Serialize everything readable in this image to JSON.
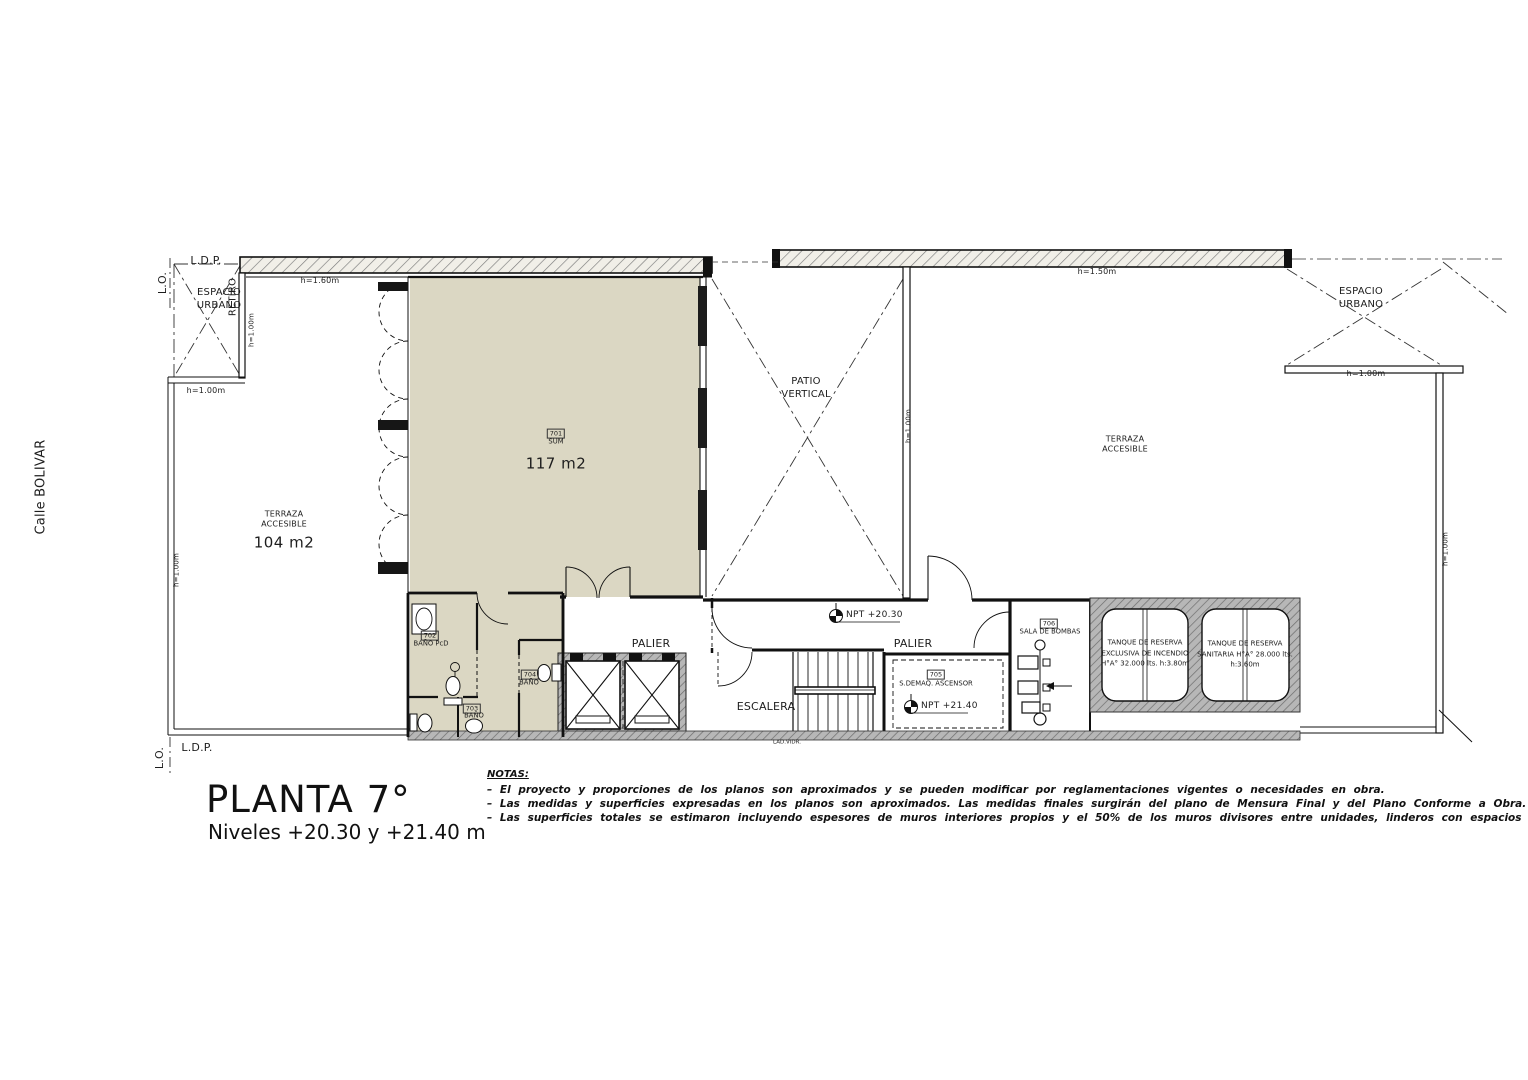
{
  "title_block": {
    "title": "PLANTA 7°",
    "subtitle": "Niveles +20.30 y +21.40 m"
  },
  "notes": {
    "heading": "NOTAS:",
    "items": [
      "– El proyecto y proporciones de los planos son aproximados y se pueden modificar por reglamentaciones vigentes o necesidades en obra.",
      "– Las medidas y superficies expresadas en los planos son aproximados. Las medidas finales surgirán del plano de Mensura Final y del Plano Conforme a Obra.",
      "– Las superficies totales se estimaron incluyendo espesores de muros interiores propios y el 50% de los muros divisores entre unidades, linderos con espacios comunes y medianeros."
    ]
  },
  "street": {
    "label": "Calle BOLIVAR"
  },
  "boundary": {
    "lo_top": "L.O.",
    "ldp_top": "L.D.P.",
    "lo_bottom": "L.O.",
    "ldp_bottom": "L.D.P."
  },
  "zones": {
    "espacio_urbano_left": "ESPACIO\nURBANO",
    "retiro": "RETIRO",
    "patio_vertical": "PATIO\nVERTICAL",
    "espacio_urbano_right": "ESPACIO\nURBANO",
    "terraza_left_name": "TERRAZA\nACCESIBLE",
    "terraza_left_area": "104 m2",
    "terraza_right_name": "TERRAZA\nACCESIBLE"
  },
  "heights": {
    "top_left": "h=1.60m",
    "top_right": "h=1.50m",
    "left_upper_v": "h=1.00m",
    "left_step": "h=1.00m",
    "left_lower_v": "h=1.00m",
    "patio_wall_v": "h=1.00m",
    "right_step": "h=1.00m",
    "right_edge_v": "h=1.00m"
  },
  "rooms": {
    "sum": {
      "number": "701",
      "name": "SUM",
      "area": "117 m2"
    },
    "banio_pcd": {
      "number": "702",
      "name": "BAÑO PcD"
    },
    "banio_703": {
      "number": "703",
      "name": "BAÑO"
    },
    "banio_704": {
      "number": "704",
      "name": "BAÑO"
    },
    "sala_maquinas": {
      "number": "705",
      "name": "S.DEMAQ. ASCENSOR"
    },
    "sala_bombas": {
      "number": "706",
      "name": "SALA DE BOMBAS"
    }
  },
  "core": {
    "palier_1": "PALIER",
    "palier_2": "PALIER",
    "escalera": "ESCALERA",
    "npt_low": "NPT +20.30",
    "npt_high": "NPT +21.40",
    "lad_vidr": "LAD.VIDR."
  },
  "tanks": {
    "incendio": "TANQUE DE RESERVA\nEXCLUSIVA DE INCENDIO\nH°A° 32.000 lts. h:3.80m",
    "sanitaria": "TANQUE DE RESERVA\nSANITARIA H°A° 28.000 lts.\nh:3.60m"
  },
  "colors": {
    "room_fill": "#dbd7c3",
    "line": "#1a1a1a"
  }
}
